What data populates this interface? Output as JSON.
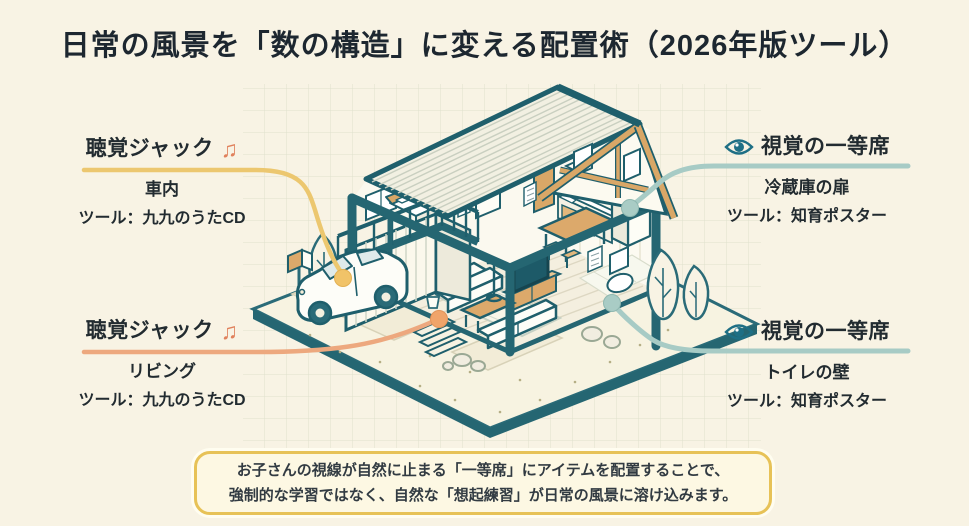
{
  "title": "日常の風景を「数の構造」に変える配置術（2026年版ツール）",
  "annotations": {
    "audio_top": {
      "heading": "聴覚ジャック",
      "icon_glyph": "♫",
      "location": "車内",
      "tool": "ツール：九九のうたCD"
    },
    "audio_bottom": {
      "heading": "聴覚ジャック",
      "icon_glyph": "♫",
      "location": "リビング",
      "tool": "ツール：九九のうたCD"
    },
    "visual_top": {
      "heading": "視覚の一等席",
      "location": "冷蔵庫の扉",
      "tool": "ツール：知育ポスター"
    },
    "visual_bottom": {
      "heading": "視覚の一等席",
      "location": "トイレの壁",
      "tool": "ツール：知育ポスター"
    }
  },
  "note": {
    "line1": "お子さんの視線が自然に止まる「一等席」にアイテムを配置することで、",
    "line2": "強制的な学習ではなく、自然な「想起練習」が日常の風景に溶け込みます。"
  },
  "diagram": {
    "type": "isometric-house-cutaway",
    "targets": [
      "車内（車）",
      "リビング",
      "冷蔵庫の扉",
      "トイレの壁"
    ]
  },
  "colors": {
    "background": "#f8f3e4",
    "outline_teal": "#1f5f6c",
    "accent_yellow": "#ecc76f",
    "accent_salmon": "#eda87e",
    "accent_teal_light": "#a7cbc5",
    "icon_coral": "#e0815c",
    "icon_eye_teal": "#1e6f85",
    "wood": "#d9a767",
    "note_border": "#e7c257",
    "note_bg": "#fdf8e3"
  }
}
